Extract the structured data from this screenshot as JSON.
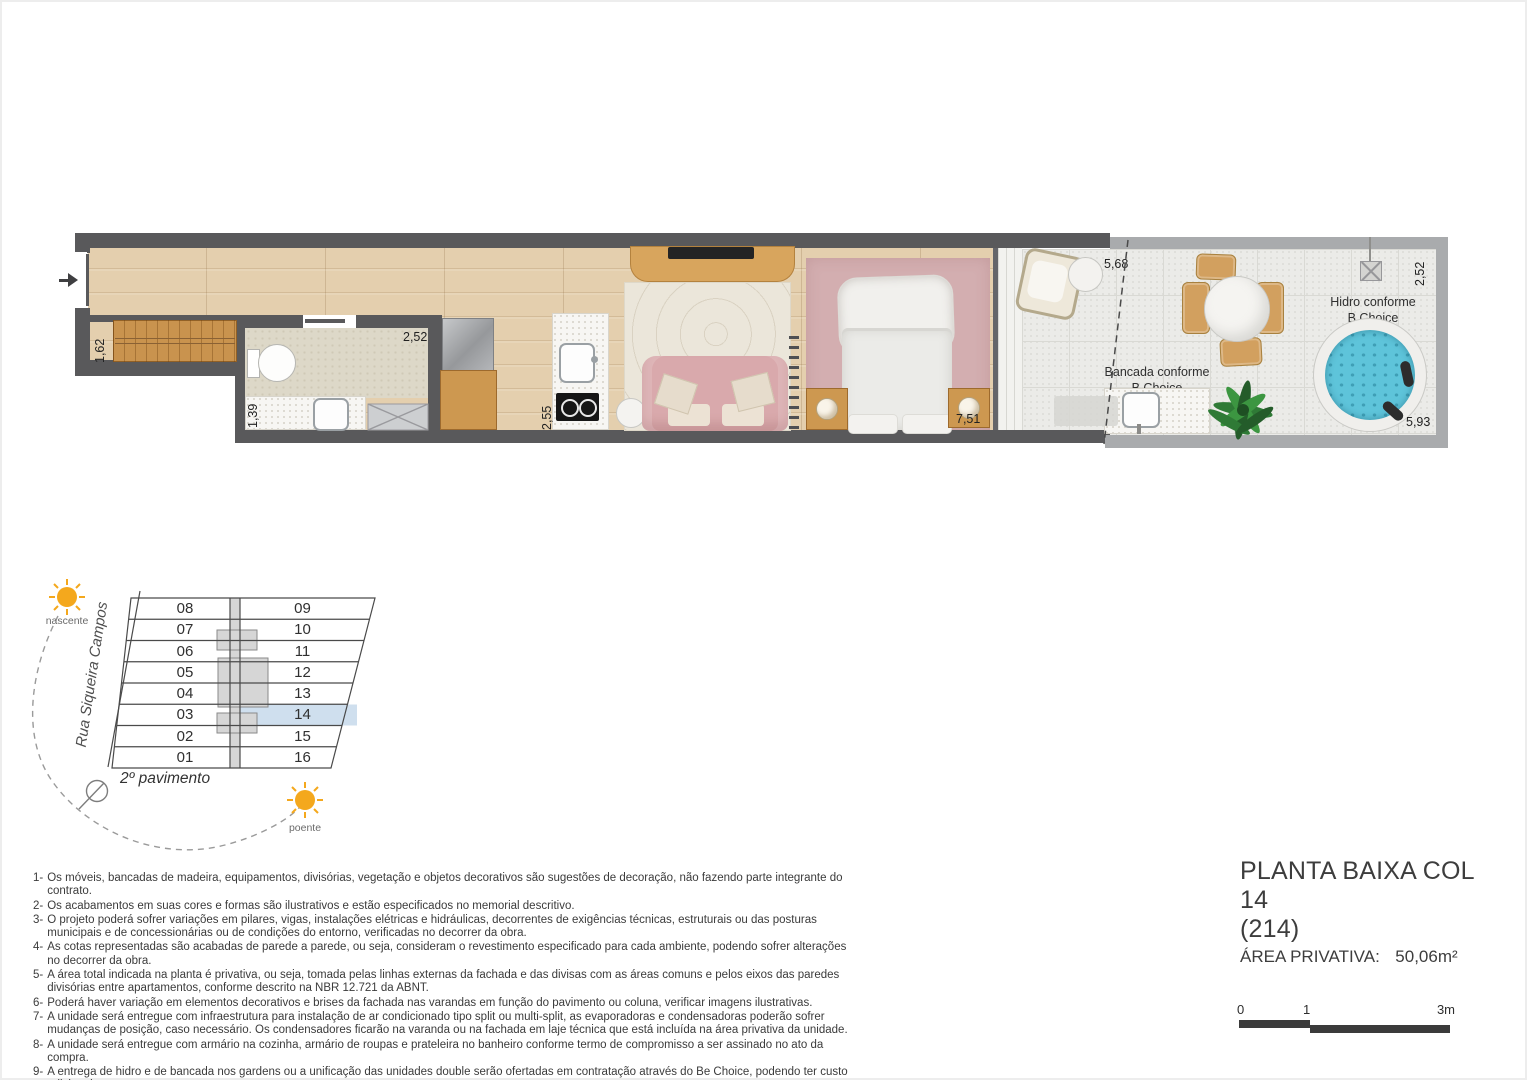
{
  "plan": {
    "dims": {
      "closet": "1,62",
      "bath_width": "1,39",
      "bath_depth": "2,52",
      "kitchen": "2,55",
      "bedroom": "7,51",
      "terrace_top": "5,68",
      "terrace_right": "2,52",
      "terrace_bottom": "5,93"
    },
    "labels": {
      "bancada_l1": "Bancada conforme",
      "bancada_l2": "B Choice",
      "hidro_l1": "Hidro conforme",
      "hidro_l2": "B Choice"
    }
  },
  "keyplan": {
    "street": "Rua Siqueira Campos",
    "floor": "2º pavimento",
    "sun_east": "nascente",
    "sun_west": "poente",
    "left_units": [
      "08",
      "07",
      "06",
      "05",
      "04",
      "03",
      "02",
      "01"
    ],
    "right_units": [
      "09",
      "10",
      "11",
      "12",
      "13",
      "14",
      "15",
      "16"
    ],
    "highlighted_unit": "14"
  },
  "notes": [
    {
      "num": "1-",
      "text": "Os móveis, bancadas de madeira, equipamentos, divisórias, vegetação e objetos decorativos são sugestões de decoração, não fazendo parte integrante do contrato."
    },
    {
      "num": "2-",
      "text": "Os acabamentos em suas cores e formas são ilustrativos e estão especificados no memorial descritivo."
    },
    {
      "num": "3-",
      "text": "O projeto poderá sofrer variações em pilares, vigas, instalações elétricas e hidráulicas, decorrentes de exigências técnicas, estruturais ou das posturas municipais e de concessionárias ou de condições do entorno, verificadas no decorrer da obra."
    },
    {
      "num": "4-",
      "text": "As cotas representadas são acabadas de parede a parede, ou seja, consideram o revestimento especificado para cada ambiente, podendo sofrer alterações no decorrer da obra."
    },
    {
      "num": "5-",
      "text": "A área total indicada na planta é privativa, ou seja, tomada pelas linhas externas da fachada e das divisas com as áreas comuns e pelos eixos das paredes divisórias entre apartamentos, conforme descrito na NBR 12.721 da ABNT."
    },
    {
      "num": "6-",
      "text": "Poderá haver variação em elementos decorativos e brises da fachada nas varandas em função do pavimento ou coluna, verificar imagens ilustrativas."
    },
    {
      "num": "7-",
      "text": "A unidade será entregue com infraestrutura para instalação de ar condicionado tipo split ou multi-split, as evaporadoras e condensadoras poderão sofrer mudanças de posição, caso necessário. Os condensadores ficarão na varanda ou na fachada em laje técnica que está incluída na área privativa da unidade."
    },
    {
      "num": "8-",
      "text": "A unidade será entregue com armário na cozinha, armário de roupas e prateleira no banheiro conforme termo de compromisso a ser assinado no ato da compra."
    },
    {
      "num": "9-",
      "text": "A entrega de hidro e de bancada nos gardens ou a unificação das unidades double serão ofertadas em contratação através do Be Choice, podendo ter custo adicional."
    },
    {
      "num": "10-",
      "text": "O layout é meramente ilustrativo e não será entregue, exceto os moveis planejados que fizerem parte do termo promocional assinado pelo cliente."
    }
  ],
  "title_block": {
    "title": "PLANTA BAIXA COL 14",
    "unit": "(214)",
    "area_label": "ÁREA PRIVATIVA:",
    "area_value": "50,06m²"
  },
  "scale_bar": {
    "start": "0",
    "mid": "1",
    "end": "3m"
  },
  "colors": {
    "wall": "#59595b",
    "terrace_wall": "#a9abad",
    "wood_floor": "#e4cfae",
    "unit_highlight": "#cfdfee",
    "sun": "#f4a81d",
    "hidro_water": "#5ec4da",
    "sofa_pink": "#d9a9ac"
  }
}
